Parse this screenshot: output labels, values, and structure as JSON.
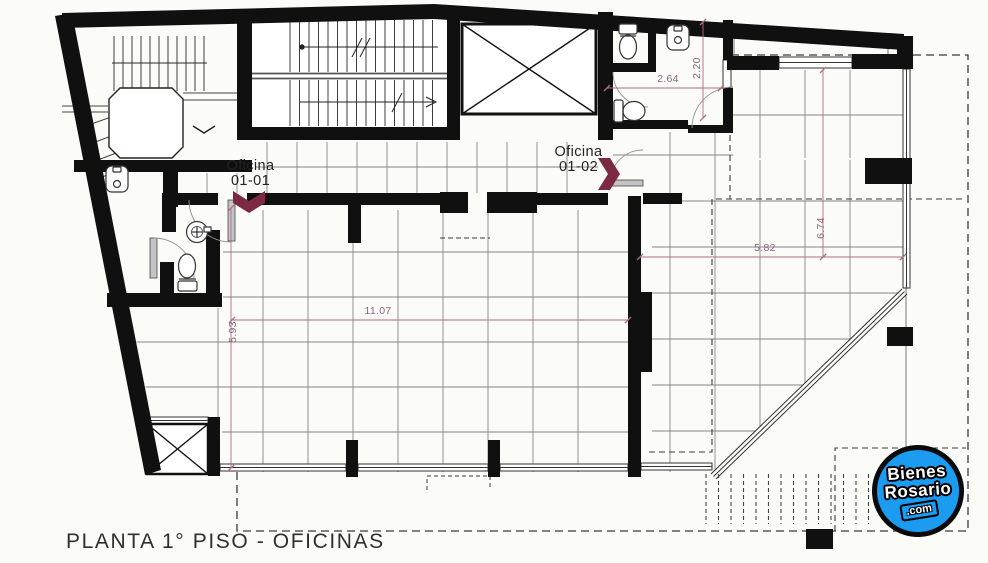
{
  "page": {
    "title": "PLANTA 1° PISO - OFICINAS"
  },
  "rooms": {
    "office1": {
      "line1": "Oficina",
      "line2": "01-01"
    },
    "office2": {
      "line1": "Oficina",
      "line2": "01-02"
    }
  },
  "dimensions": {
    "main_width": "11.07",
    "main_depth": "5.93",
    "right_width": "5.82",
    "right_depth": "6.74",
    "bath_width": "2.64",
    "bath_depth": "2.20"
  },
  "logo": {
    "line1": "Bienes",
    "line2": "Rosario",
    "line3": ".com",
    "background": "#1b9cf0"
  },
  "icons": {
    "toilet": "toilet-icon",
    "sink": "sink-icon",
    "elevator_shaft": "elevator-x-icon",
    "stairs": "stairs-icon",
    "door_swing": "door-swing-icon"
  },
  "colors": {
    "wall": "#101010",
    "tile_grid": "#858585",
    "dimension_line": "#b06c86",
    "dimension_text": "#8d6380",
    "room_marker": "#7c2a44",
    "dashed_line": "#3a3a3a",
    "logo_blue": "#1b9cf0"
  }
}
